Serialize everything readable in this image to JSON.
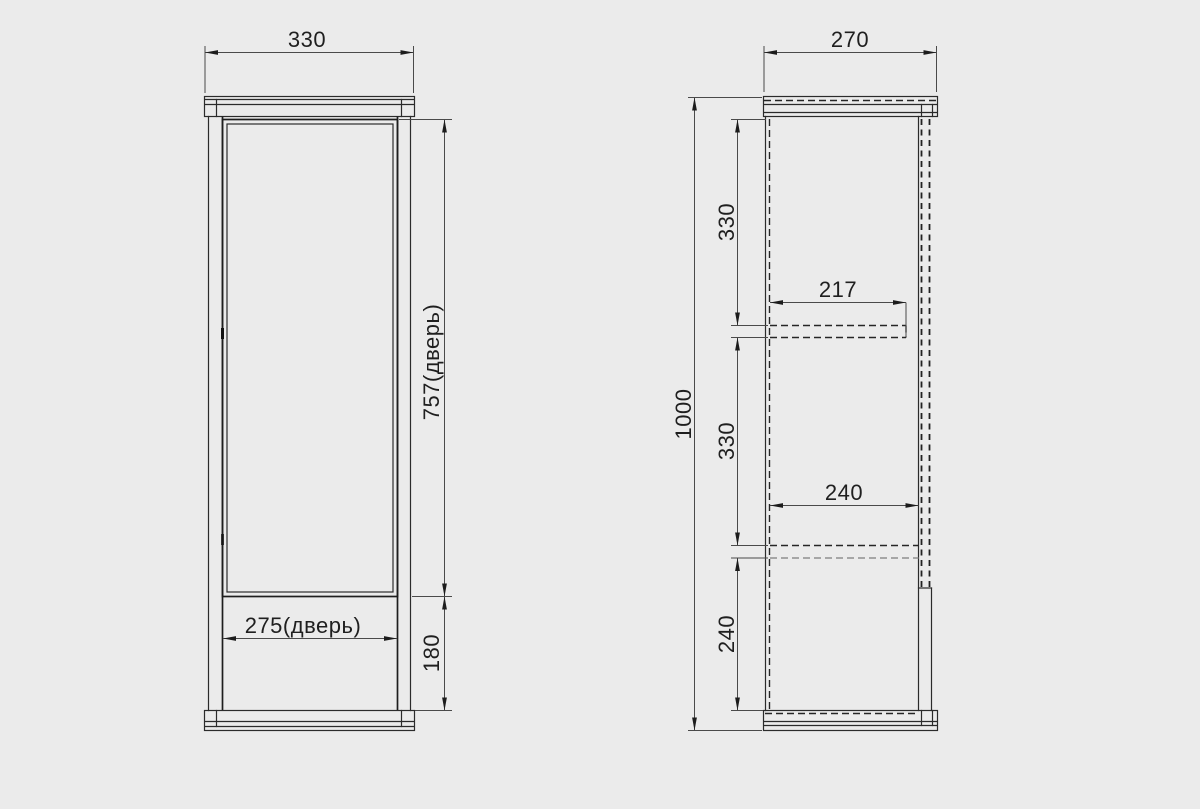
{
  "colors": {
    "background": "#ebebeb",
    "line": "#2b2b2b",
    "dim_line": "#4a4a4a",
    "text": "#1f1f1f"
  },
  "front_view": {
    "dim_width": "330",
    "dim_door_height": "757(дверь)",
    "dim_door_width": "275(дверь)",
    "dim_plinth_height": "180"
  },
  "side_view": {
    "dim_depth": "270",
    "dim_total_height": "1000",
    "dim_section_top": "330",
    "dim_section_middle": "330",
    "dim_section_bottom": "240",
    "dim_shelf_upper_depth": "217",
    "dim_shelf_lower_depth": "240"
  }
}
